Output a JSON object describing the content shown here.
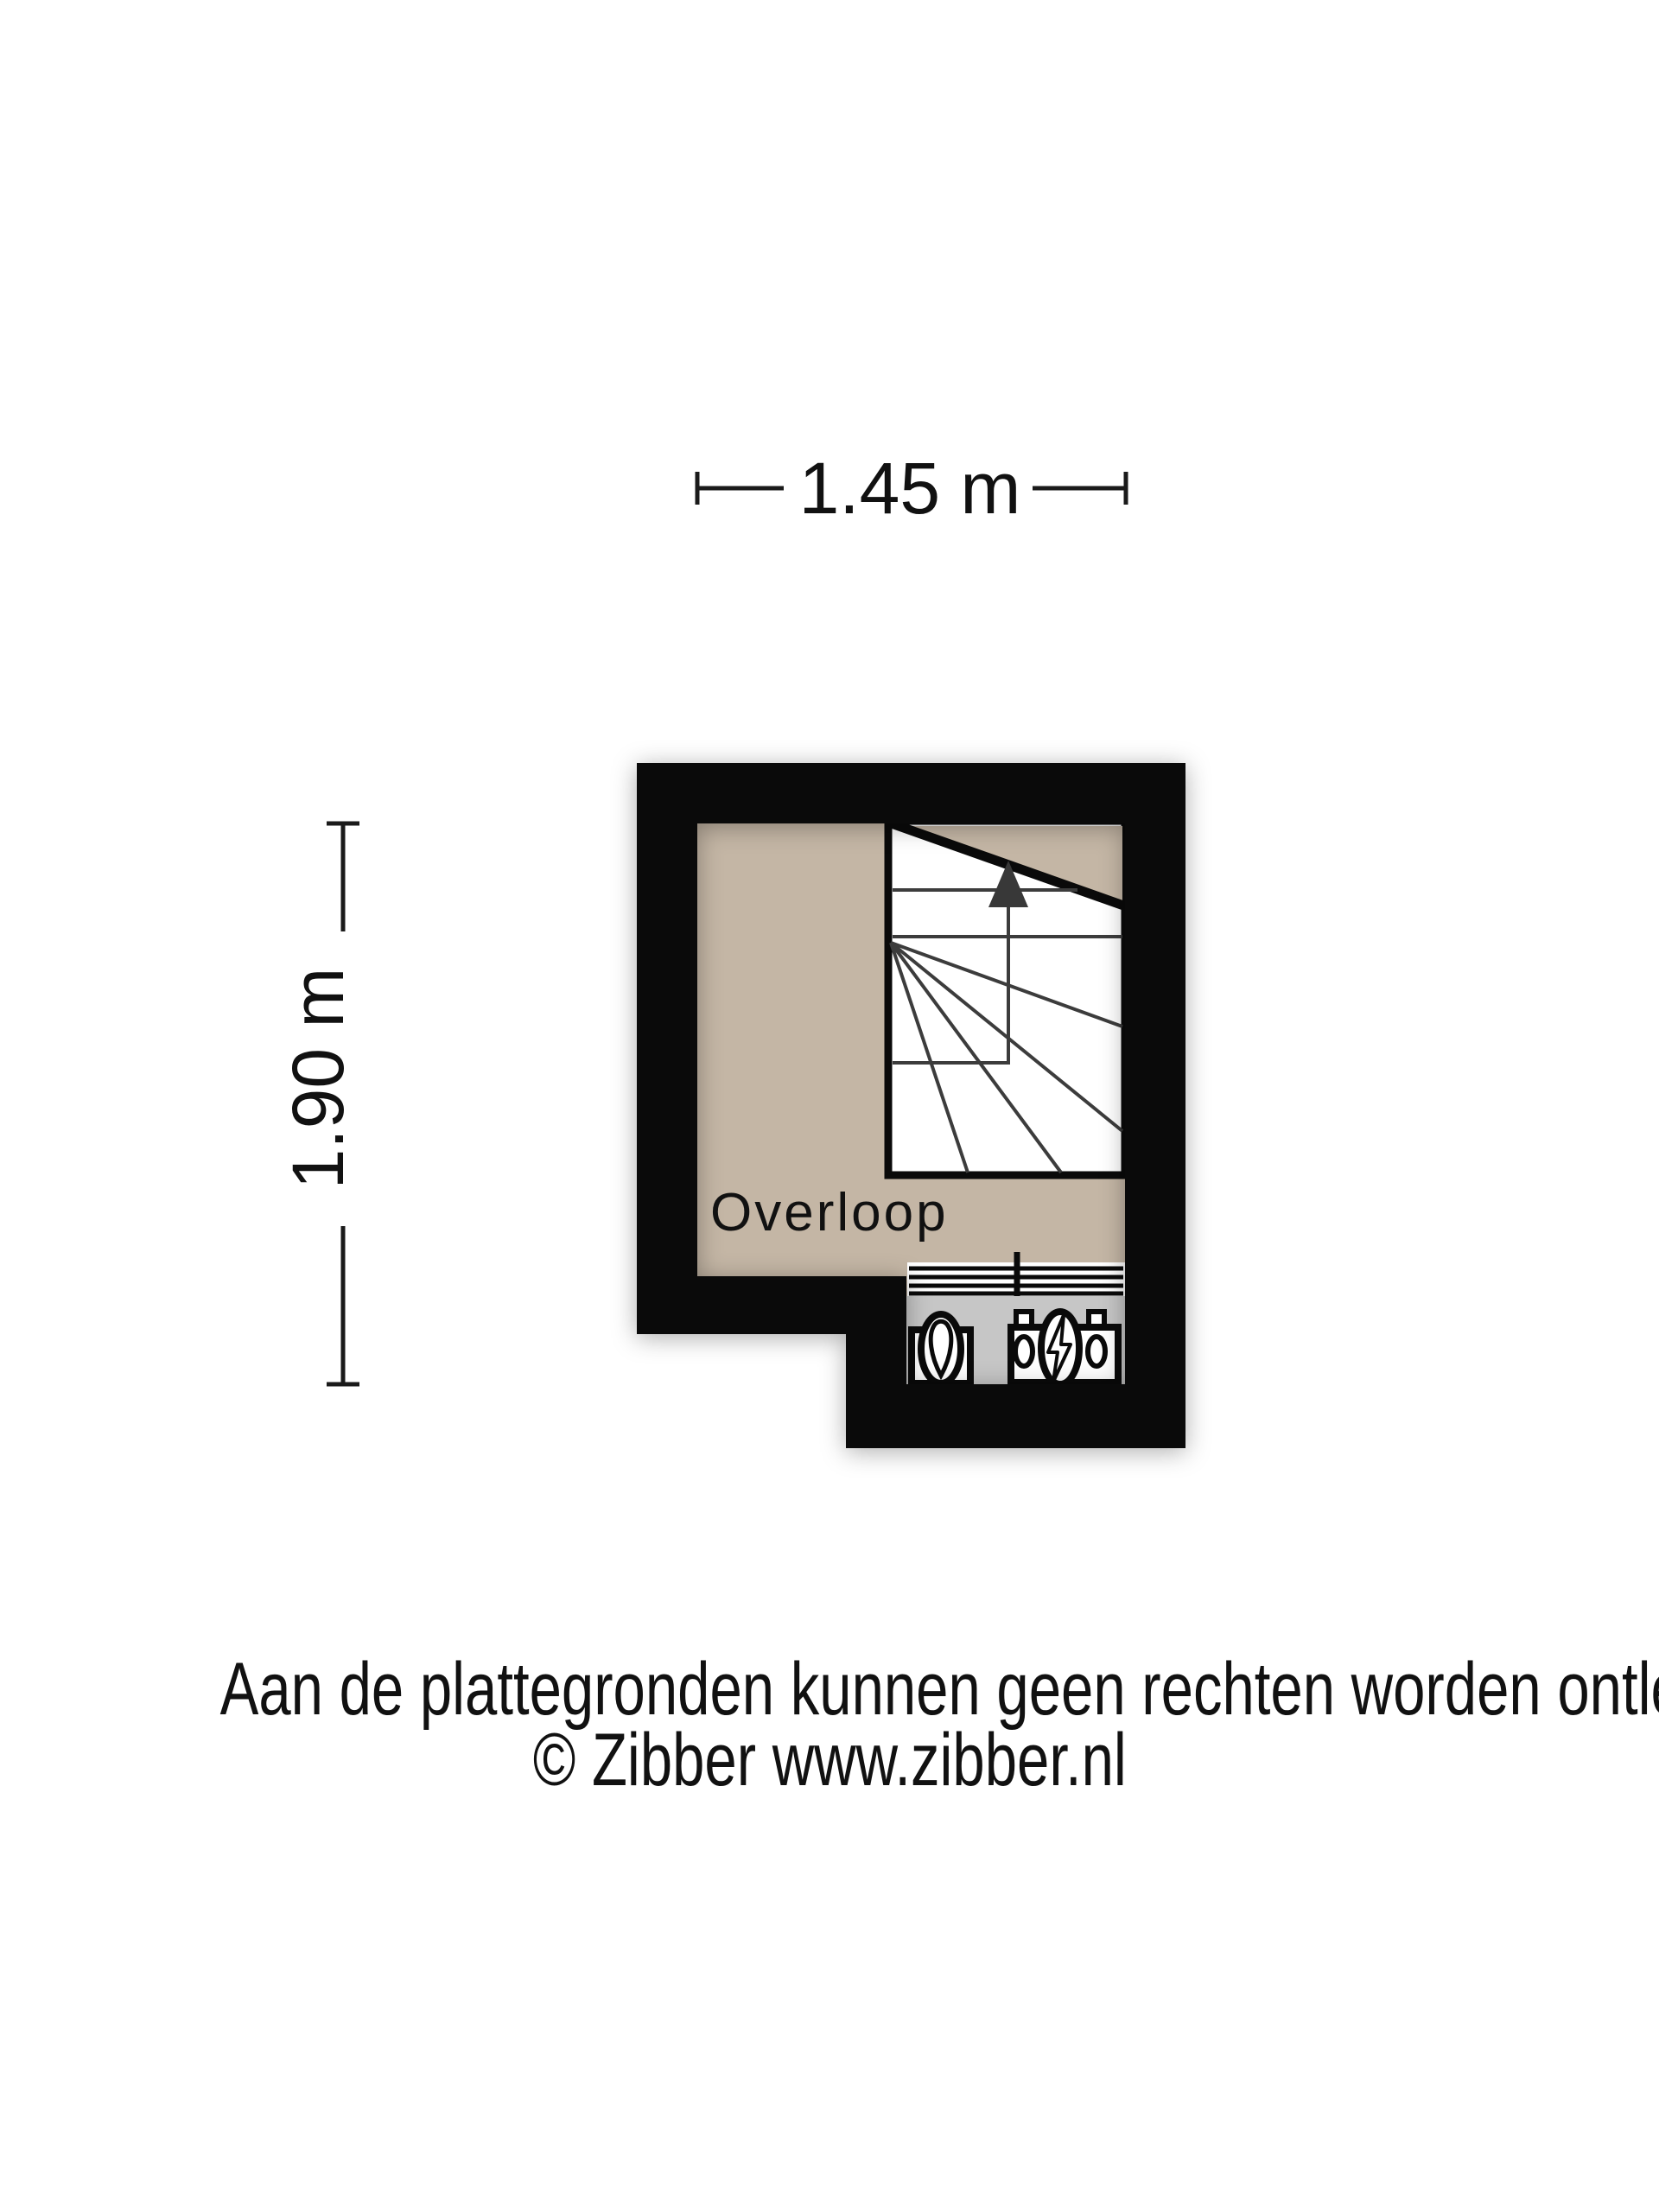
{
  "dimensions": {
    "width": {
      "label": "1.45 m"
    },
    "height": {
      "label": "1.90 m"
    }
  },
  "room": {
    "name": "Overloop"
  },
  "footer": {
    "disclaimer": "Aan de plattegronden kunnen geen rechten worden ontleend",
    "copyright": "© Zibber www.zibber.nl"
  },
  "colors": {
    "wall": "#0a0a0a",
    "floor": "#c4b6a5",
    "stairs_bg": "#ffffff",
    "tread": "#3c3c3c",
    "arrow": "#383838",
    "appliance_zone": "#c6c6c6",
    "text": "#111111"
  },
  "icons": {
    "stairs_direction": "up-arrow-icon",
    "left_appliance": "boiler-icon",
    "right_appliance": "electricity-meter-icon",
    "heater": "radiator-icon"
  }
}
